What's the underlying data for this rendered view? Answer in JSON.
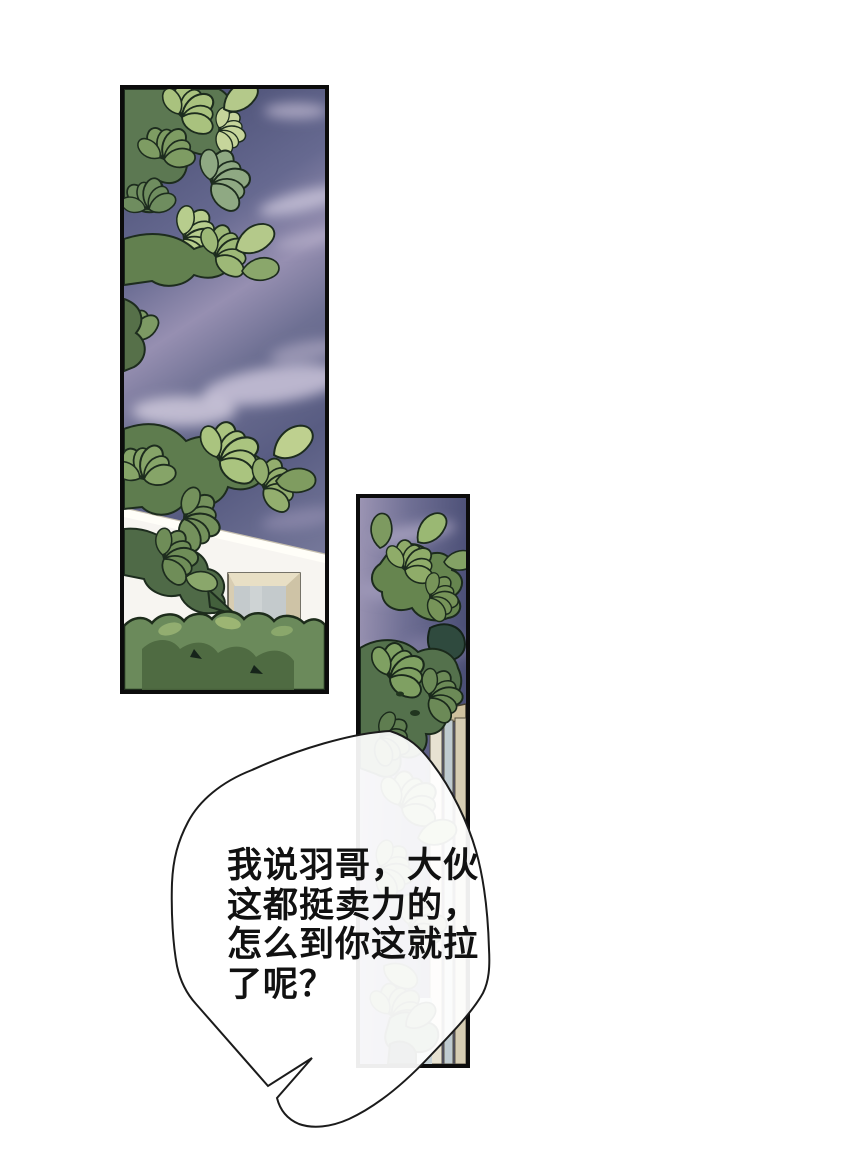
{
  "page": {
    "kind": "comic-page",
    "background": "#ffffff"
  },
  "panels": [
    {
      "id": "panel-top-left",
      "content": "tree branches against a purple cloudy sky; white building with windows and a hedge at the bottom"
    },
    {
      "id": "panel-right",
      "content": "tall narrow panel of shrub foliage and a railing against a purple cloudy sky"
    }
  ],
  "speech_bubble": {
    "lines": [
      "我说羽哥，大伙",
      "这都挺卖力的，",
      "怎么到你这就拉",
      "了呢？"
    ]
  },
  "colors": {
    "page_bg": "#ffffff",
    "text_color": "#111111",
    "line_color": "#1b1b1b",
    "bubble_fill": "rgba(255,255,255,0.93)",
    "sky_dark": "#4b4f76",
    "sky_light": "#9b94b3",
    "cloud": "#cfc9dd",
    "leaf_light": "#b7cd8d",
    "leaf_mid": "#7e9c63",
    "leaf_dark": "#4f6a47",
    "leaf_outline": "#1d2c1e",
    "wall": "#f7f5f1",
    "window_frame": "#d8cdb2",
    "window_glass": "#c4cacc"
  }
}
